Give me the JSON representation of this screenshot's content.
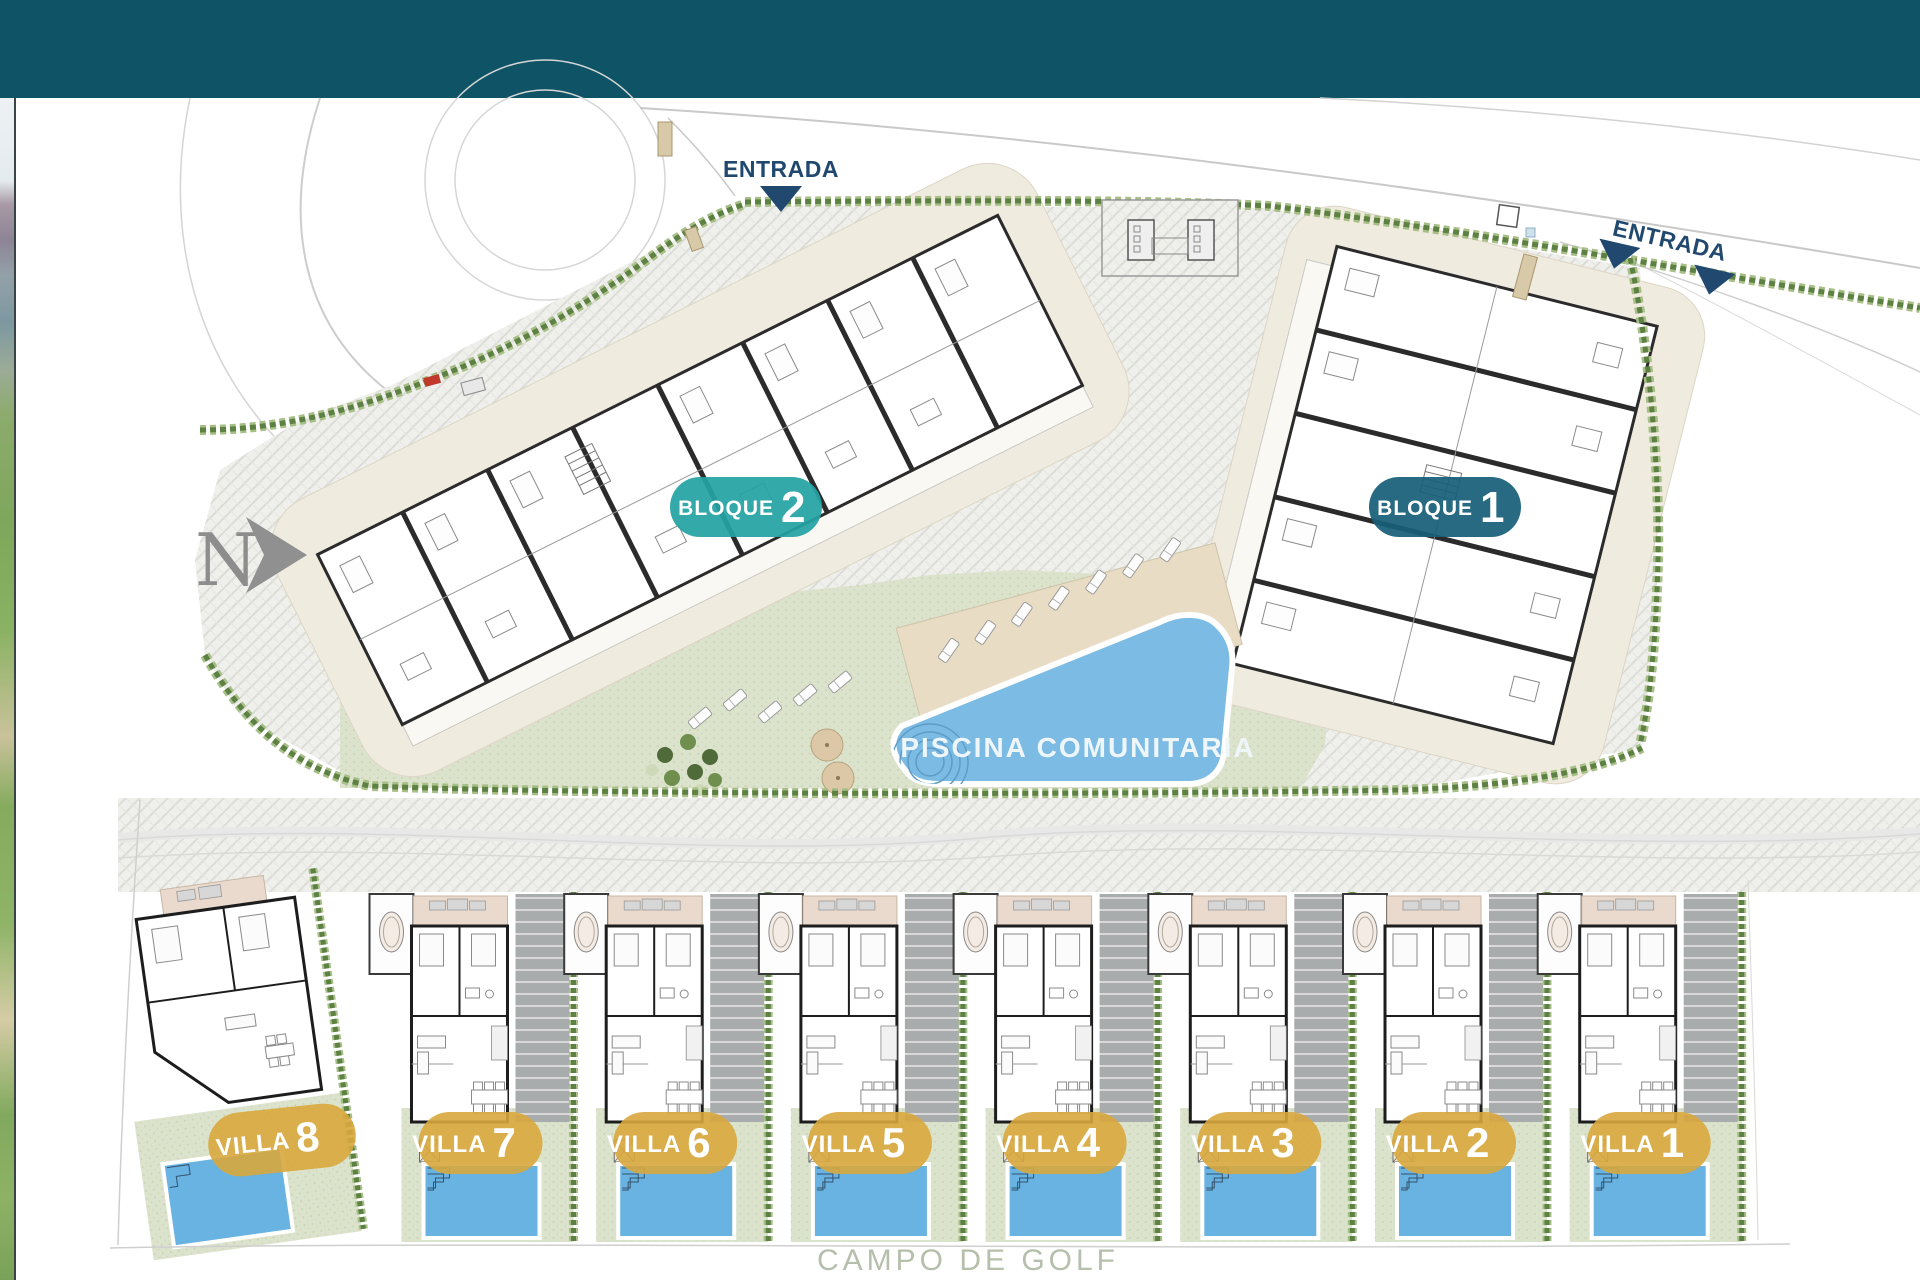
{
  "plan": {
    "type": "residential development site plan",
    "north_indicator": {
      "label": "N"
    },
    "entrances": [
      {
        "label": "ENTRADA"
      },
      {
        "label": "ENTRADA"
      }
    ],
    "blocks": [
      {
        "name": "BLOQUE",
        "number": "2",
        "badge_color": "#23a2a4"
      },
      {
        "name": "BLOQUE",
        "number": "1",
        "badge_color": "#175f78"
      }
    ],
    "pool": {
      "label": "PISCINA COMUNITARIA",
      "water_color": "#7cbbe3"
    },
    "villas": [
      {
        "name": "VILLA",
        "number": "8"
      },
      {
        "name": "VILLA",
        "number": "7"
      },
      {
        "name": "VILLA",
        "number": "6"
      },
      {
        "name": "VILLA",
        "number": "5"
      },
      {
        "name": "VILLA",
        "number": "4"
      },
      {
        "name": "VILLA",
        "number": "3"
      },
      {
        "name": "VILLA",
        "number": "2"
      },
      {
        "name": "VILLA",
        "number": "1"
      }
    ],
    "golf_course": {
      "label": "CAMPO DE GOLF"
    },
    "colors": {
      "banner": "#0e5466",
      "villa_badge": "#d8a73d",
      "villa_pool": "#68b3e2",
      "hedge_dark": "#5d8142",
      "hedge_light": "#a7bf87",
      "lawn": "#dce3cc",
      "terrace_cream": "#f0ebdf",
      "navy": "#21486e"
    }
  }
}
